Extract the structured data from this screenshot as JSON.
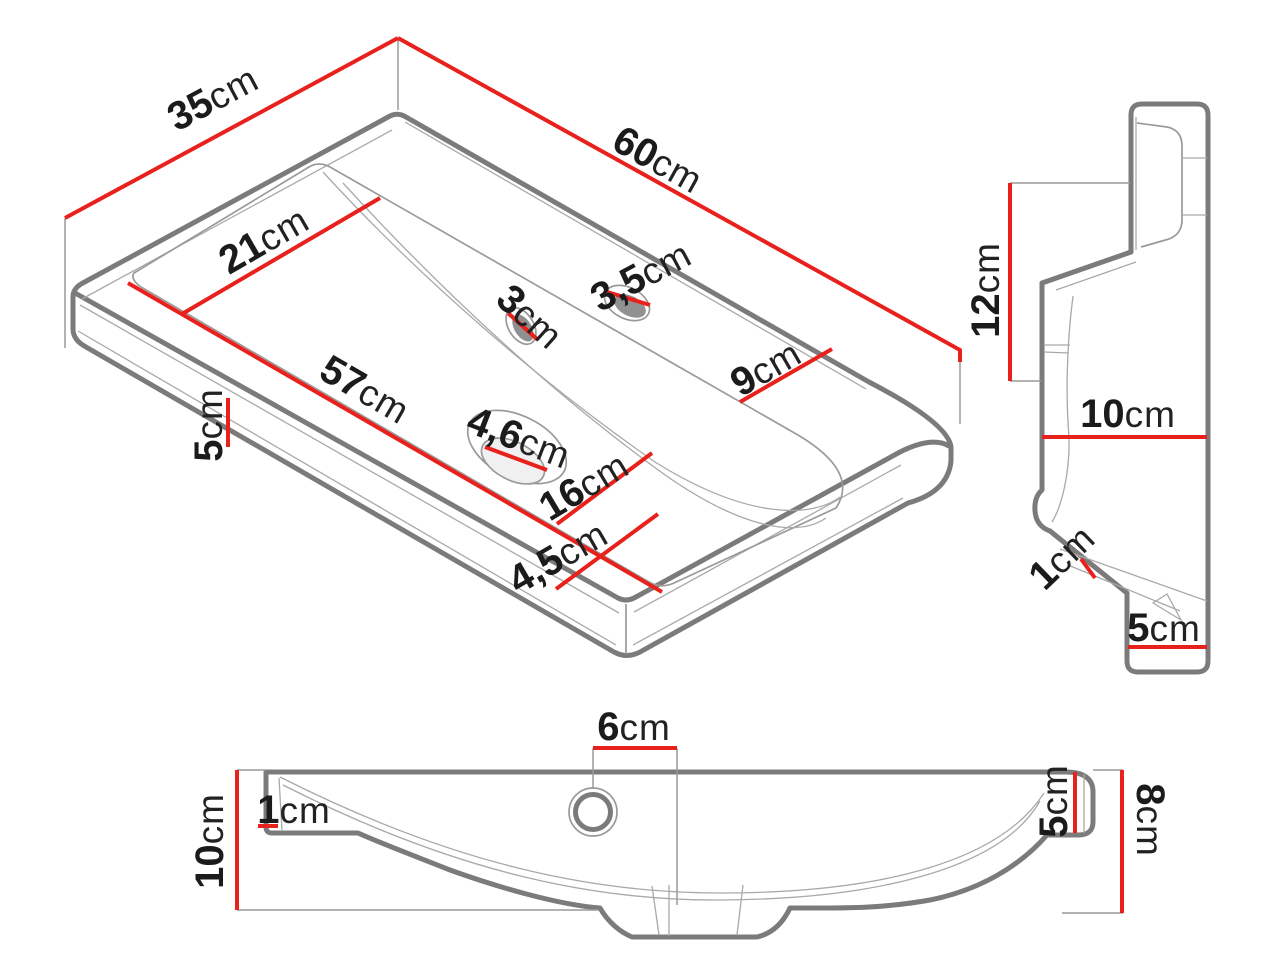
{
  "title": "washbasin-dimension-drawing",
  "colors": {
    "red": "#e8211c",
    "outline": "#7b7b7b",
    "thin_line": "#9a9a9a",
    "text": "#1b1b1b",
    "background": "#ffffff"
  },
  "views": {
    "isometric": {
      "name": "isometric-view",
      "dims": [
        {
          "id": "top-depth",
          "num": "35",
          "unit": "cm"
        },
        {
          "id": "top-length",
          "num": "60",
          "unit": "cm"
        },
        {
          "id": "basin-depth",
          "num": "21",
          "unit": "cm"
        },
        {
          "id": "faucet-hole",
          "num": "3,5",
          "unit": "cm"
        },
        {
          "id": "overflow-hole",
          "num": "3",
          "unit": "cm"
        },
        {
          "id": "right-deck",
          "num": "9",
          "unit": "cm"
        },
        {
          "id": "basin-length",
          "num": "57",
          "unit": "cm"
        },
        {
          "id": "edge-height",
          "num": "5",
          "unit": "cm"
        },
        {
          "id": "drain-hole",
          "num": "4,6",
          "unit": "cm"
        },
        {
          "id": "drain-offset",
          "num": "16",
          "unit": "cm"
        },
        {
          "id": "front-deck",
          "num": "4,5",
          "unit": "cm"
        }
      ]
    },
    "side": {
      "name": "side-profile-view",
      "dims": [
        {
          "id": "back-height",
          "num": "12",
          "unit": "cm"
        },
        {
          "id": "bowl-depth",
          "num": "10",
          "unit": "cm"
        },
        {
          "id": "lip-thickness",
          "num": "1",
          "unit": "cm"
        },
        {
          "id": "base-height",
          "num": "5",
          "unit": "cm"
        }
      ]
    },
    "front": {
      "name": "front-section-view",
      "dims": [
        {
          "id": "hole-offset",
          "num": "6",
          "unit": "cm"
        },
        {
          "id": "wall-thickness",
          "num": "1",
          "unit": "cm"
        },
        {
          "id": "total-height",
          "num": "10",
          "unit": "cm"
        },
        {
          "id": "right-height",
          "num": "5",
          "unit": "cm"
        },
        {
          "id": "right-end-height",
          "num": "8",
          "unit": "cm"
        }
      ]
    }
  }
}
